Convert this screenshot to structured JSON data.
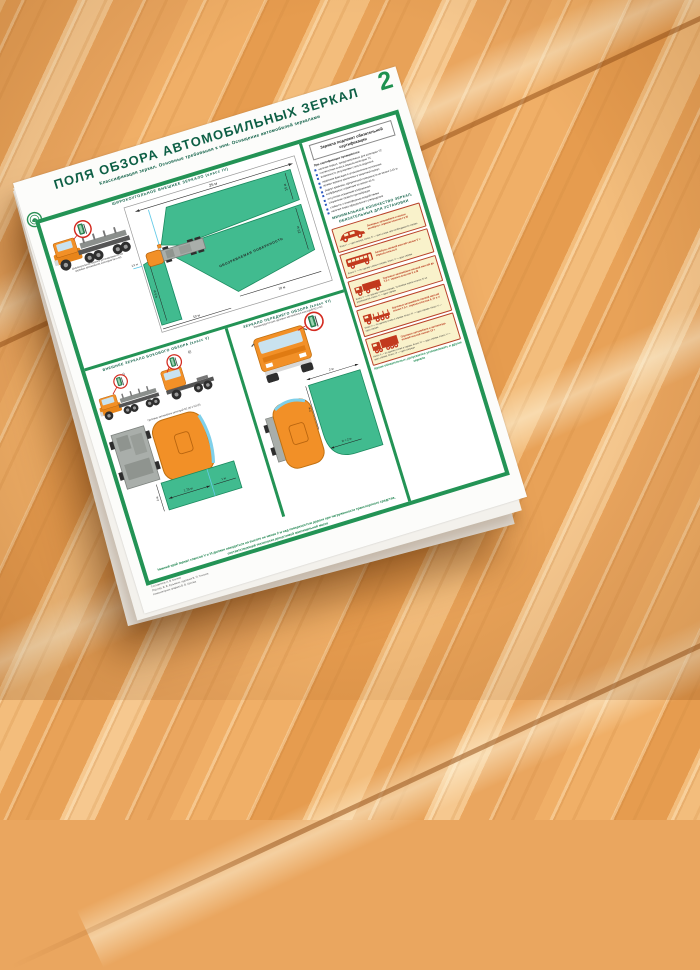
{
  "colors": {
    "frame_green": "#239355",
    "title_green": "#0d5f45",
    "field_green": "#41bb8f",
    "truck_orange": "#f29027",
    "cream": "#f9f2cb",
    "pictogram_red": "#c2391d",
    "wood": "#eaa65f"
  },
  "poster": {
    "corner_number": "2",
    "title": "ПОЛЯ ОБЗОРА АВТОМОБИЛЬНЫХ ЗЕРКАЛ",
    "subtitle": "Классификация зеркал. Основные требования к ним. Оснащение автомобилей зеркалами",
    "wide_angle": {
      "header": "ШИРОКОУГОЛЬНОЕ ВНЕШНЕЕ ЗЕРКАЛО (класс IV)",
      "truck_caption_1": "Широкоугольное зеркало устанавливается на",
      "truck_caption_2": "грузовых автомобилях категорий N2 и N3",
      "surface_label": "ОБОЗРЕВАЕМАЯ ПОВЕРХНОСТЬ",
      "dim_top": "25 м",
      "dim_right_upper": "15 м",
      "dim_right_lower": "15 м",
      "dim_left": "4,5 м",
      "dim_bottom_left": "10 м",
      "dim_bottom_right": "10 м",
      "dim_small": "1,5 м"
    },
    "side_view": {
      "header": "ВНЕШНЕЕ ЗЕРКАЛО БОКОВОГО ОБЗОРА (класс V)",
      "label_a": "а)",
      "label_b": "б)",
      "caption": "Грузовые автомобили категорий N2 (а) и N3 (б)",
      "dim_width": "1,75 м",
      "dim_width2": "1 м",
      "dim_height": "2 м"
    },
    "front_view": {
      "header": "ЗЕРКАЛО ПЕРЕДНЕГО ОБЗОРА (класс VI)",
      "caption": "Рекомендуется для грузовых автомобилей категорий N2 и N3",
      "dim_top": "2 м",
      "dim_radius": "R = 2 м",
      "dim_left": "2 м"
    },
    "certification": {
      "title": "Зеркала подлежат обязательной сертификации",
      "intro": "При сертификации проверяются:",
      "bullets": [
        "наличие зеркал, предусмотренных для категории ТС",
        "соответствие класса зеркала категории ТС",
        "возможность регулировки с места водителя",
        "надёжная фиксация в установленном положении",
        "кромки зеркала заключены в защитный корпус",
        "радиус кривизны сферической поверхности не менее 0,15 м",
        "коэффициент отражения не менее 40 %",
        "отсутствие искажений изображения",
        "сохранение свойств при вибрации",
        "стойкость к атмосферным воздействиям",
        "наличие знака официального утверждения"
      ]
    },
    "minimum": {
      "header": "МИНИМАЛЬНОЕ КОЛИЧЕСТВО ЗЕРКАЛ, ОБЯЗАТЕЛЬНЫХ ДЛЯ УСТАНОВКИ",
      "boxes": [
        {
          "caption": "Легковые автомобили и малые автобусы: зеркала классов I и III",
          "note": "Класс I — одно внутри. Класс III — одно слева, при необходимости справа"
        },
        {
          "caption": "Автобусы полной массой свыше 5 т: зеркала класса II",
          "note": "Класс II — по одному слева и справа. Класс V — одно справа"
        },
        {
          "caption": "Грузовые автомобили полной массой до 7,5 т: зеркала классов II и III",
          "note": "Класс II — по одному слева и справа. Установка зеркал класса IV не разрешается. Класс V — одно справа"
        },
        {
          "caption": "Грузовые автомобили полной массой свыше 7,5 т: зеркала классов II, IV и V",
          "note": "Класс II — по одному слева и справа. Класс IV — одно справа. Класс V — одно справа"
        },
        {
          "caption": "Грузовые автомобили и автопоезда полной массой свыше 12 т",
          "note": "Класс II — по одному слева и справа. Класс IV — одно справа. Класс V — одно справа. Класс VI — одно спереди"
        }
      ],
      "footer": "Кроме обязательных, допускается устанавливать и другие зеркала"
    },
    "bottom_note": "Нижний край зеркал классов V и VI должен находиться на высоте не менее 2 м над поверхностью дороги при нагруженности транспортного средства, соответствующей технически допустимой максимальной массе",
    "credits": [
      "Составитель А. В. Беляев",
      "Под ред. В. В. Кузьмина, художник В. П. Тихонов",
      "Компьютерная графика В. В. Орлова"
    ]
  }
}
